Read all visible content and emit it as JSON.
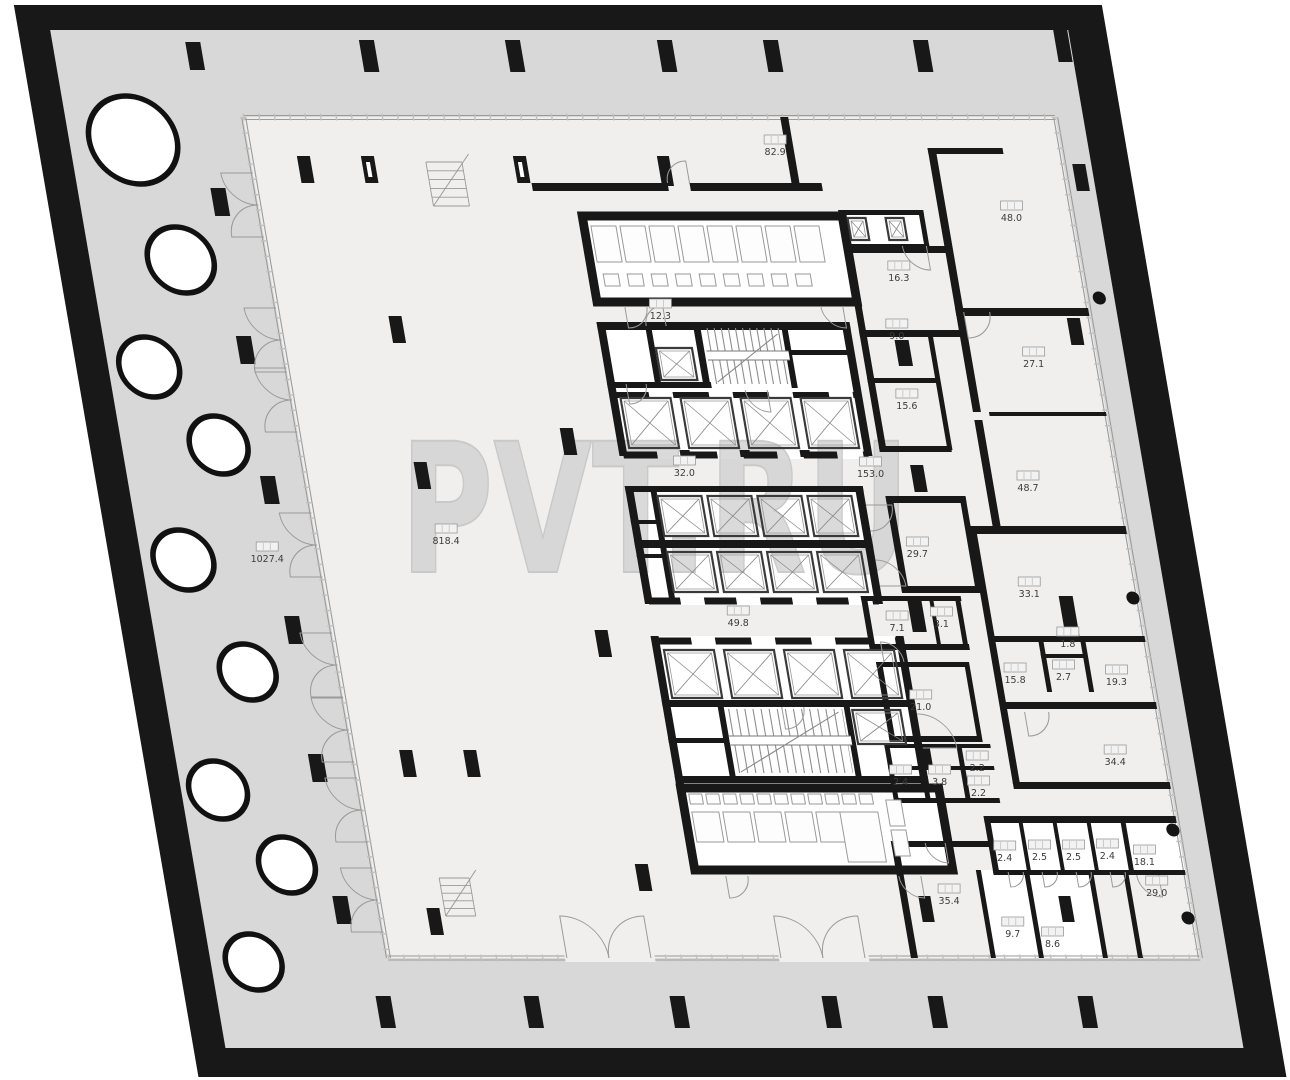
{
  "watermark_text": "PVT.RU",
  "plan_title": "floor-plan",
  "colors": {
    "wall": "#181818",
    "terrace": "#d8d8d8",
    "floor": "#f0efee",
    "room_white": "#ffffff",
    "thin_line": "#9a9a9a",
    "watermark_fill": "#d2d2d2",
    "watermark_stroke": "#c0c0c0"
  },
  "room_labels": [
    {
      "value": "82.9",
      "x": 750,
      "y": 146
    },
    {
      "value": "48.0",
      "x": 975,
      "y": 212
    },
    {
      "value": "16.3",
      "x": 852,
      "y": 272
    },
    {
      "value": "12.3",
      "x": 607,
      "y": 310
    },
    {
      "value": "9.0",
      "x": 840,
      "y": 330
    },
    {
      "value": "27.1",
      "x": 972,
      "y": 358
    },
    {
      "value": "15.6",
      "x": 838,
      "y": 400
    },
    {
      "value": "32.0",
      "x": 604,
      "y": 467
    },
    {
      "value": "153.0",
      "x": 790,
      "y": 468
    },
    {
      "value": "48.7",
      "x": 945,
      "y": 482
    },
    {
      "value": "818.4",
      "x": 354,
      "y": 535
    },
    {
      "value": "1027.4",
      "x": 172,
      "y": 553
    },
    {
      "value": "29.7",
      "x": 823,
      "y": 548
    },
    {
      "value": "33.1",
      "x": 928,
      "y": 588
    },
    {
      "value": "49.8",
      "x": 632,
      "y": 617
    },
    {
      "value": "7.1",
      "x": 790,
      "y": 622
    },
    {
      "value": "3.1",
      "x": 835,
      "y": 618
    },
    {
      "value": "1.8",
      "x": 958,
      "y": 638
    },
    {
      "value": "15.8",
      "x": 899,
      "y": 674
    },
    {
      "value": "2.7",
      "x": 948,
      "y": 671
    },
    {
      "value": "19.3",
      "x": 1000,
      "y": 676
    },
    {
      "value": "21.0",
      "x": 800,
      "y": 701
    },
    {
      "value": "2.2",
      "x": 846,
      "y": 762
    },
    {
      "value": "2.4",
      "x": 767,
      "y": 776
    },
    {
      "value": "3.8",
      "x": 806,
      "y": 776
    },
    {
      "value": "2.2",
      "x": 843,
      "y": 787
    },
    {
      "value": "34.4",
      "x": 985,
      "y": 756
    },
    {
      "value": "2.4",
      "x": 858,
      "y": 852
    },
    {
      "value": "2.5",
      "x": 893,
      "y": 851
    },
    {
      "value": "2.5",
      "x": 927,
      "y": 851
    },
    {
      "value": "2.4",
      "x": 961,
      "y": 850
    },
    {
      "value": "18.1",
      "x": 997,
      "y": 856
    },
    {
      "value": "29.0",
      "x": 1004,
      "y": 887
    },
    {
      "value": "35.4",
      "x": 795,
      "y": 895
    },
    {
      "value": "9.7",
      "x": 853,
      "y": 928
    },
    {
      "value": "8.6",
      "x": 891,
      "y": 938
    }
  ]
}
